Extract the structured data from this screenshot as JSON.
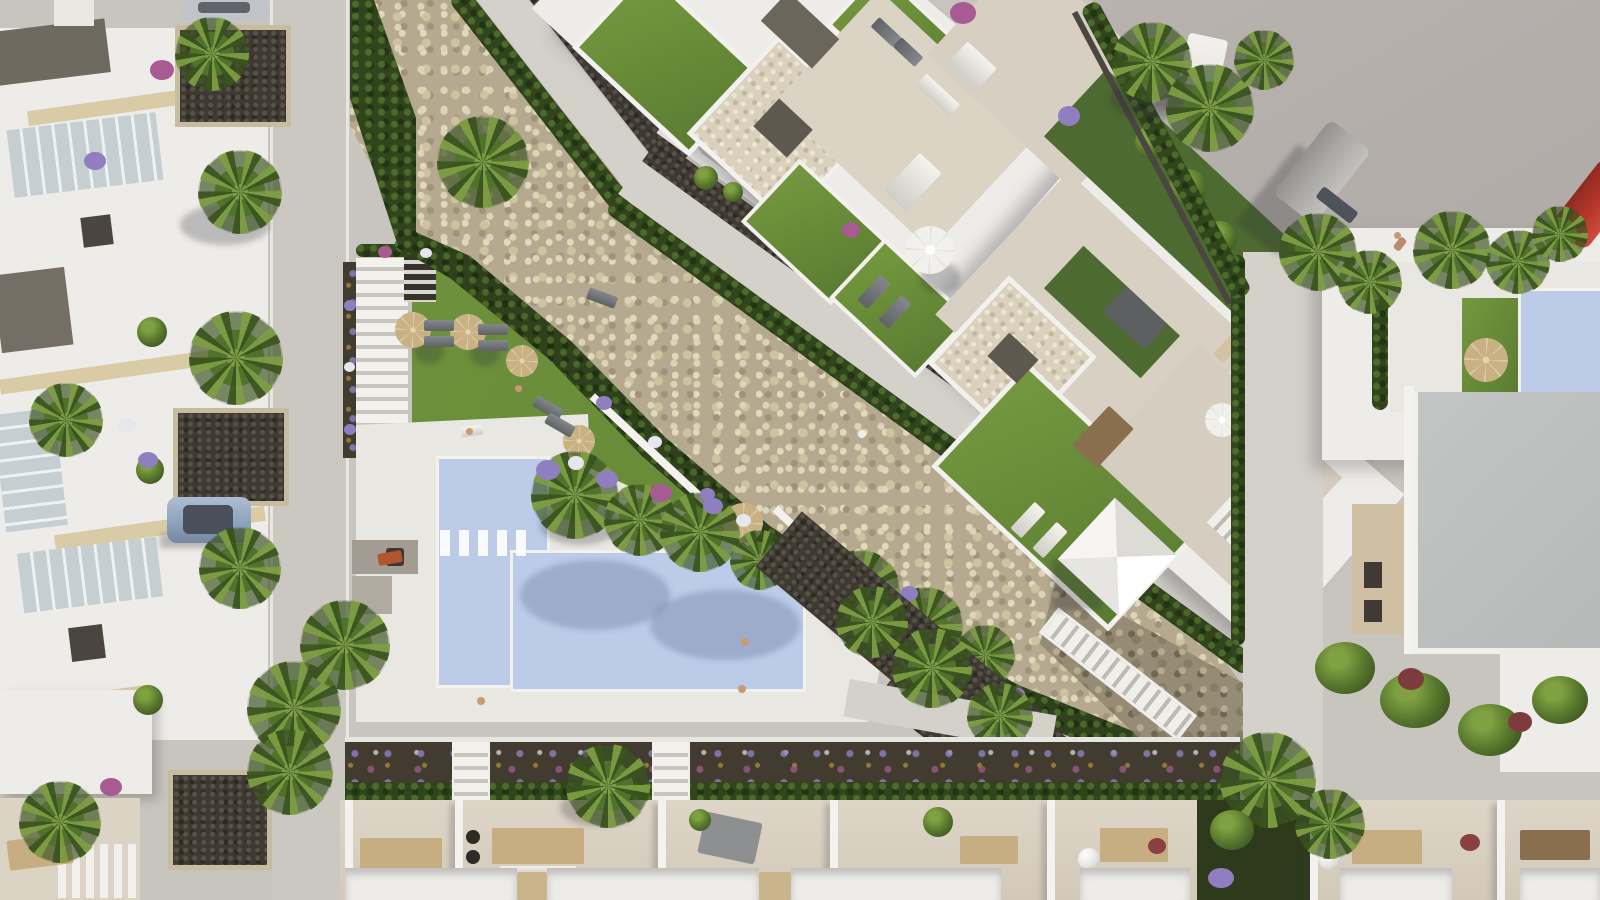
{
  "scene": {
    "type": "aerial-architectural-render",
    "description": "Top-down photorealistic render of a Mediterranean residential development: a communal L-shaped pool with sun lawn and wicker parasols, a diagonal dry stone riverbed crossed by a promenade, white apartment blocks with landscaped roof terraces, townhouse rows left and bottom, an access road with parked vehicles top-right.",
    "time_of_day": "daylight, low sun casting shadows to lower-left"
  },
  "objects": {
    "main_pool": "Communal L-shaped swimming pool",
    "pool_deck": "White sunbathing deck",
    "sun_lawn": "Lawn with wicker parasols and loungers",
    "rambla": "Dry stone riverbed (rambla)",
    "promenade": "Pedestrian promenade along riverbed",
    "apartments": "Apartment block with landscaped roof terraces",
    "townhouses_left": "Townhouse row along left street",
    "townhouses_bottom": "Townhouse terraces along bottom",
    "right_villas": "Villas with plunge pool and grey roofs",
    "plunge_pool": "Private plunge pool",
    "retaining_wall": "Stone retaining wall with staircase",
    "road": "Access road",
    "van": "Parked grey van",
    "truck": "Parked white box truck",
    "red_car": "Red car at road edge",
    "parked_car": "Blue-grey car parked on left street",
    "street_car": "Silver car at top street",
    "white_tent": "White shade canopy",
    "counts": {
      "wicker_parasols": 8,
      "white_parasols": 2,
      "sphere_lamps": 2,
      "vehicles": 5
    }
  },
  "palette": {
    "pavement": "#c8c5bf",
    "street": "#cbc8c2",
    "asphalt": "#b3adaa",
    "building_white": "#eeece8",
    "wall_white": "#f3f2ee",
    "patio_beige": "#dbd3c4",
    "deck_white": "#e9e7e2",
    "roof_grey": "#b6b9b7",
    "roof_dark": "#6f6a60",
    "lawn": "#74983f",
    "lawn_shade": "#5a7c31",
    "lawn_deep": "#4d6a30",
    "pool_water": "#bccbe8",
    "pool_water_light": "#dde6f4",
    "stones_light": "#ddd3b9",
    "stones_mid": "#b5aa8f",
    "gravel_dark": "#3e3931",
    "soil_dark": "#413b30",
    "hedge_green": "#31451d",
    "palm_green": "#55742c",
    "palm_light": "#7fa141",
    "umbrella_wicker": "#c9b183",
    "umbrella_white": "#f1f0ec",
    "flower_purple": "#8f7fc0",
    "flower_white": "#e6e6ee",
    "flower_magenta": "#a85b93",
    "flower_yellow": "#c8a23c",
    "trim_beige": "#d8cba6",
    "glass_blue": "#c5cfd2",
    "car_silver": "#c0c3c8",
    "car_blue": "#8fa3bd",
    "van_grey": "#aaa9a5",
    "truck_white": "#e9e8e4",
    "car_red": "#b5352b"
  }
}
